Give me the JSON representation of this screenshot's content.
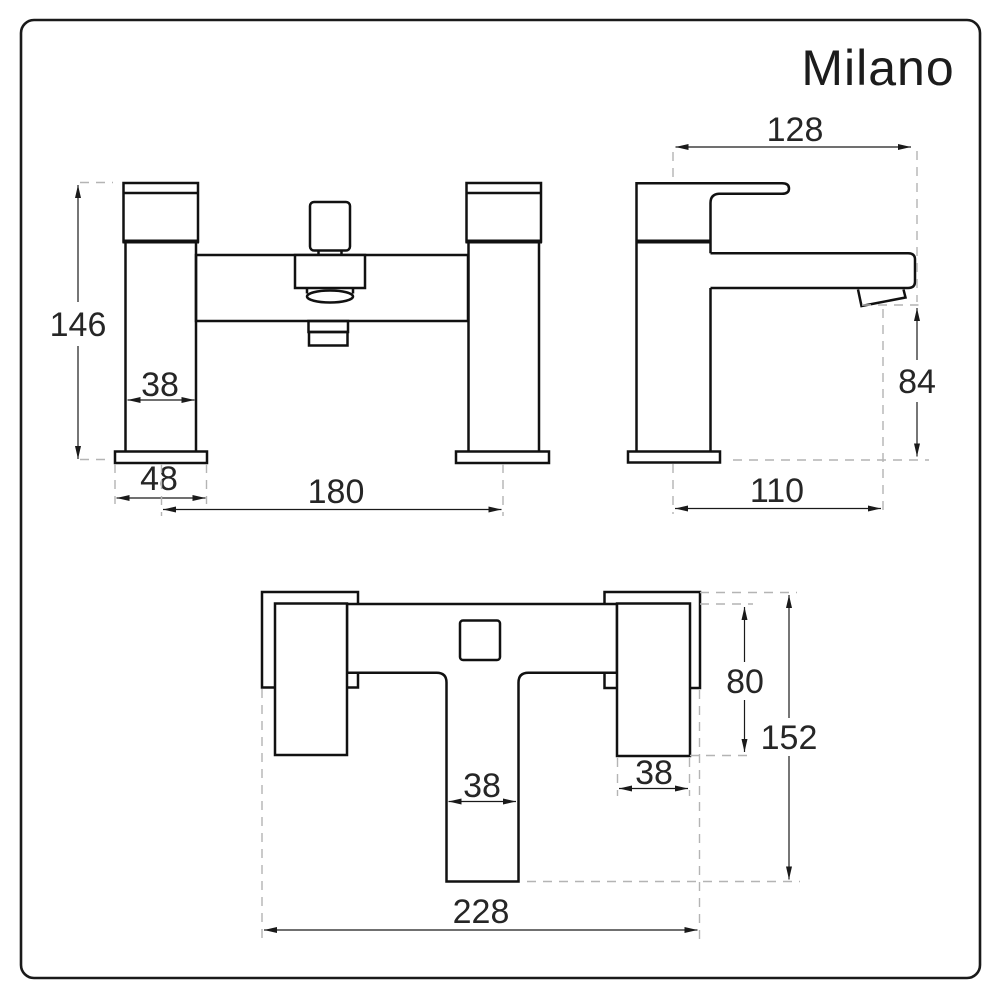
{
  "brand_logo": "Milano",
  "drawing": {
    "front_view": {
      "dims": {
        "overall_height": "146",
        "pillar_width": "38",
        "base_width": "48",
        "tap_centres": "180"
      }
    },
    "side_view": {
      "dims": {
        "overall_depth": "128",
        "spout_clearance": "84",
        "spout_reach": "110"
      }
    },
    "plan_view": {
      "dims": {
        "body_depth": "80",
        "overall_depth": "152",
        "pillar_width": "38",
        "stem_width": "38",
        "overall_width": "228"
      }
    }
  },
  "colors": {
    "line": "#111111",
    "dimension": "#1a1a1a",
    "dashed": "#b4b4b4",
    "border": "#1a1a1a",
    "background": "#ffffff"
  }
}
